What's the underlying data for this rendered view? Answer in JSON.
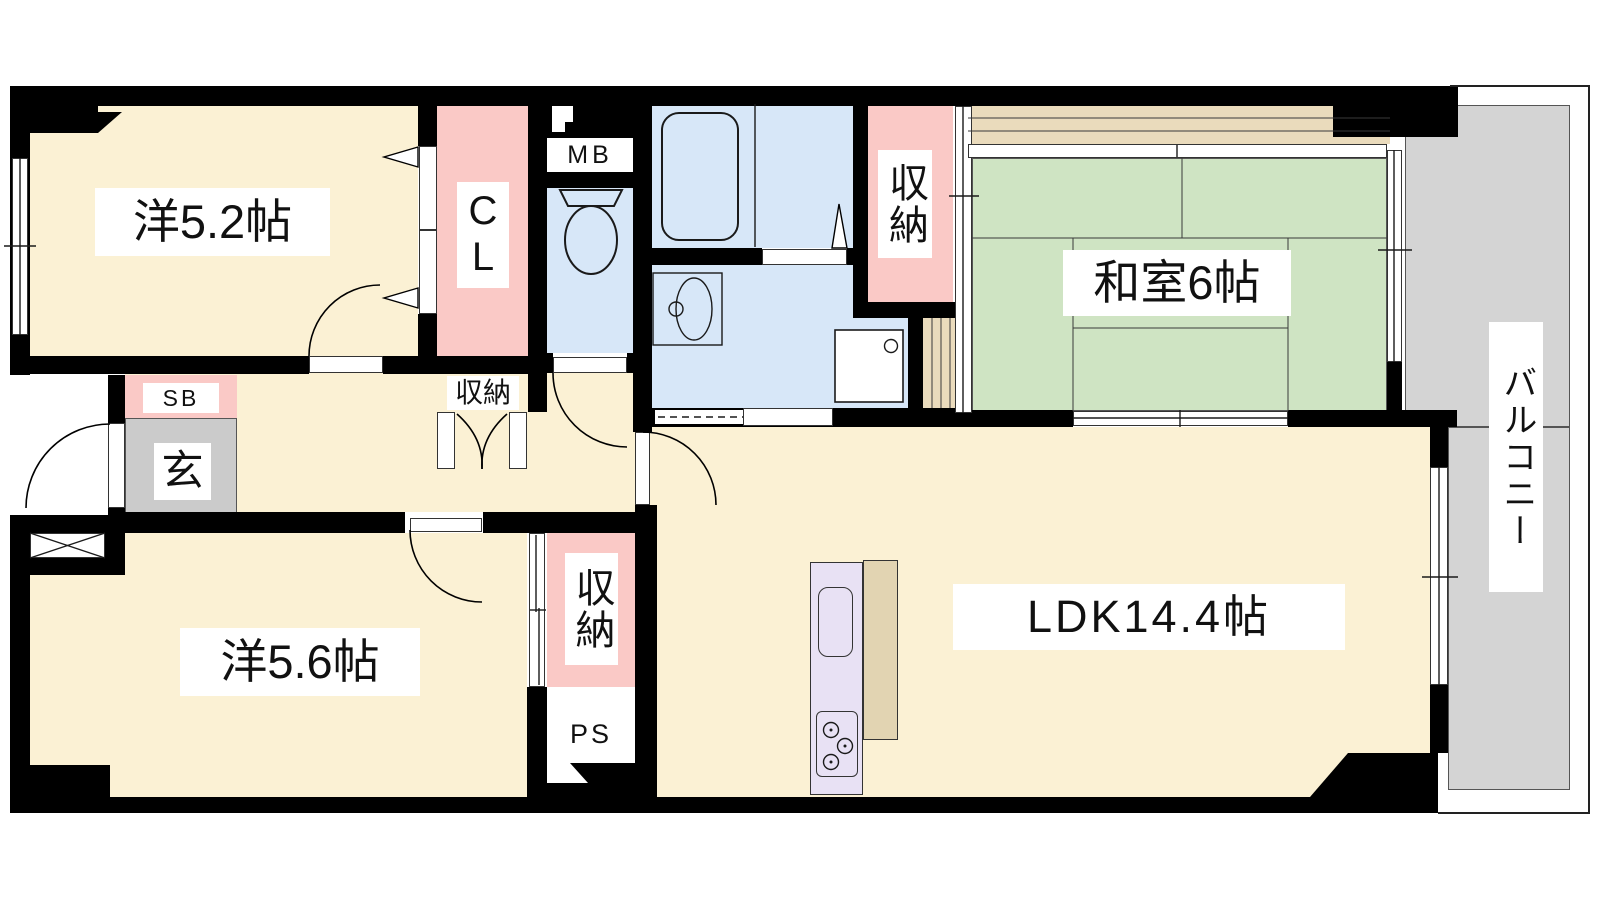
{
  "floorplan": {
    "type": "apartment-floor-plan",
    "labels": {
      "bedroom1": "洋5.2帖",
      "closet_cl": "CL",
      "meter_box": "MB",
      "bath_storage": "収納",
      "japanese_room": "和室6帖",
      "balcony": "バルコニー",
      "shoe_box": "SB",
      "entrance": "玄",
      "hall_storage": "収納",
      "center_storage": "収納",
      "pipe_space": "PS",
      "bedroom2": "洋5.6帖",
      "ldk": "LDK14.4帖"
    },
    "icons": {
      "bathtub": "bathtub-icon",
      "toilet": "toilet-icon",
      "washbasin": "washbasin-icon",
      "washing_machine": "washing-machine-icon",
      "kitchen_stove": "stove-burners-icon",
      "kitchen_sink": "kitchen-sink-icon",
      "shaft_cross": "crossed-box-icon"
    },
    "colors": {
      "wall_black": "#000000",
      "room_cream": "#fbf1d4",
      "tatami_green": "#cfe4c3",
      "closet_pink": "#fac9c6",
      "water_blue": "#d7e7f8",
      "entry_gray": "#cbcbcb",
      "balcony_gray": "#d4d4d4",
      "wood_tan": "#eadbbc",
      "kitchen_purple": "#e8e1f4",
      "counter_tan": "#e2d4b2"
    }
  }
}
